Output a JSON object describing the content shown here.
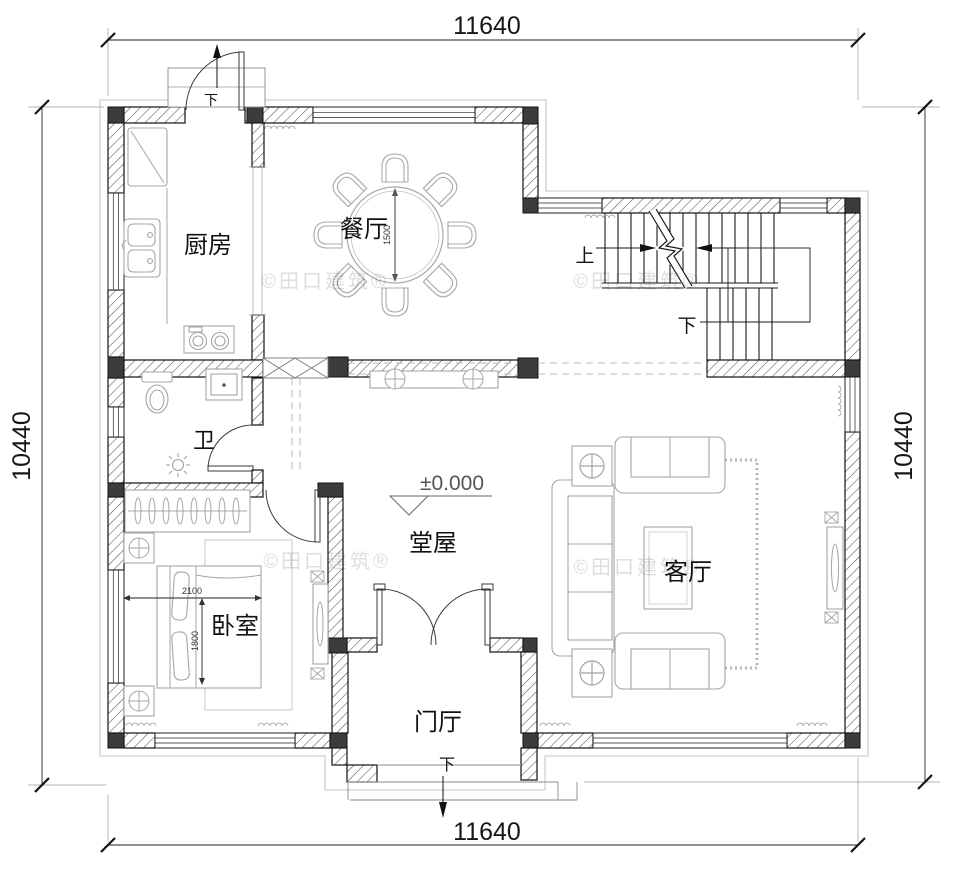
{
  "plan": {
    "dimensions": {
      "top": "11640",
      "bottom": "11640",
      "left": "10440",
      "right": "10440",
      "dining_table_diameter": "1500",
      "bed_length": "2100",
      "bed_width": "1800",
      "floor_level": "±0.000"
    },
    "rooms": {
      "kitchen": "厨房",
      "dining_room": "餐厅",
      "bathroom": "卫",
      "bedroom": "卧室",
      "hall": "堂屋",
      "living_room": "客厅",
      "foyer": "门厅"
    },
    "stairs": {
      "up": "上",
      "down": "下"
    },
    "annotations": {
      "foyer_steps_down": "下",
      "kitchen_door_down": "下"
    },
    "watermark": "©田口建筑®",
    "colors": {
      "wall_line": "#111111",
      "column_fill": "#3c3c3c",
      "furniture_line": "#a5a5a5",
      "dashed_line": "#bbbbbb",
      "watermark_gray": "#d9d9d9"
    }
  }
}
